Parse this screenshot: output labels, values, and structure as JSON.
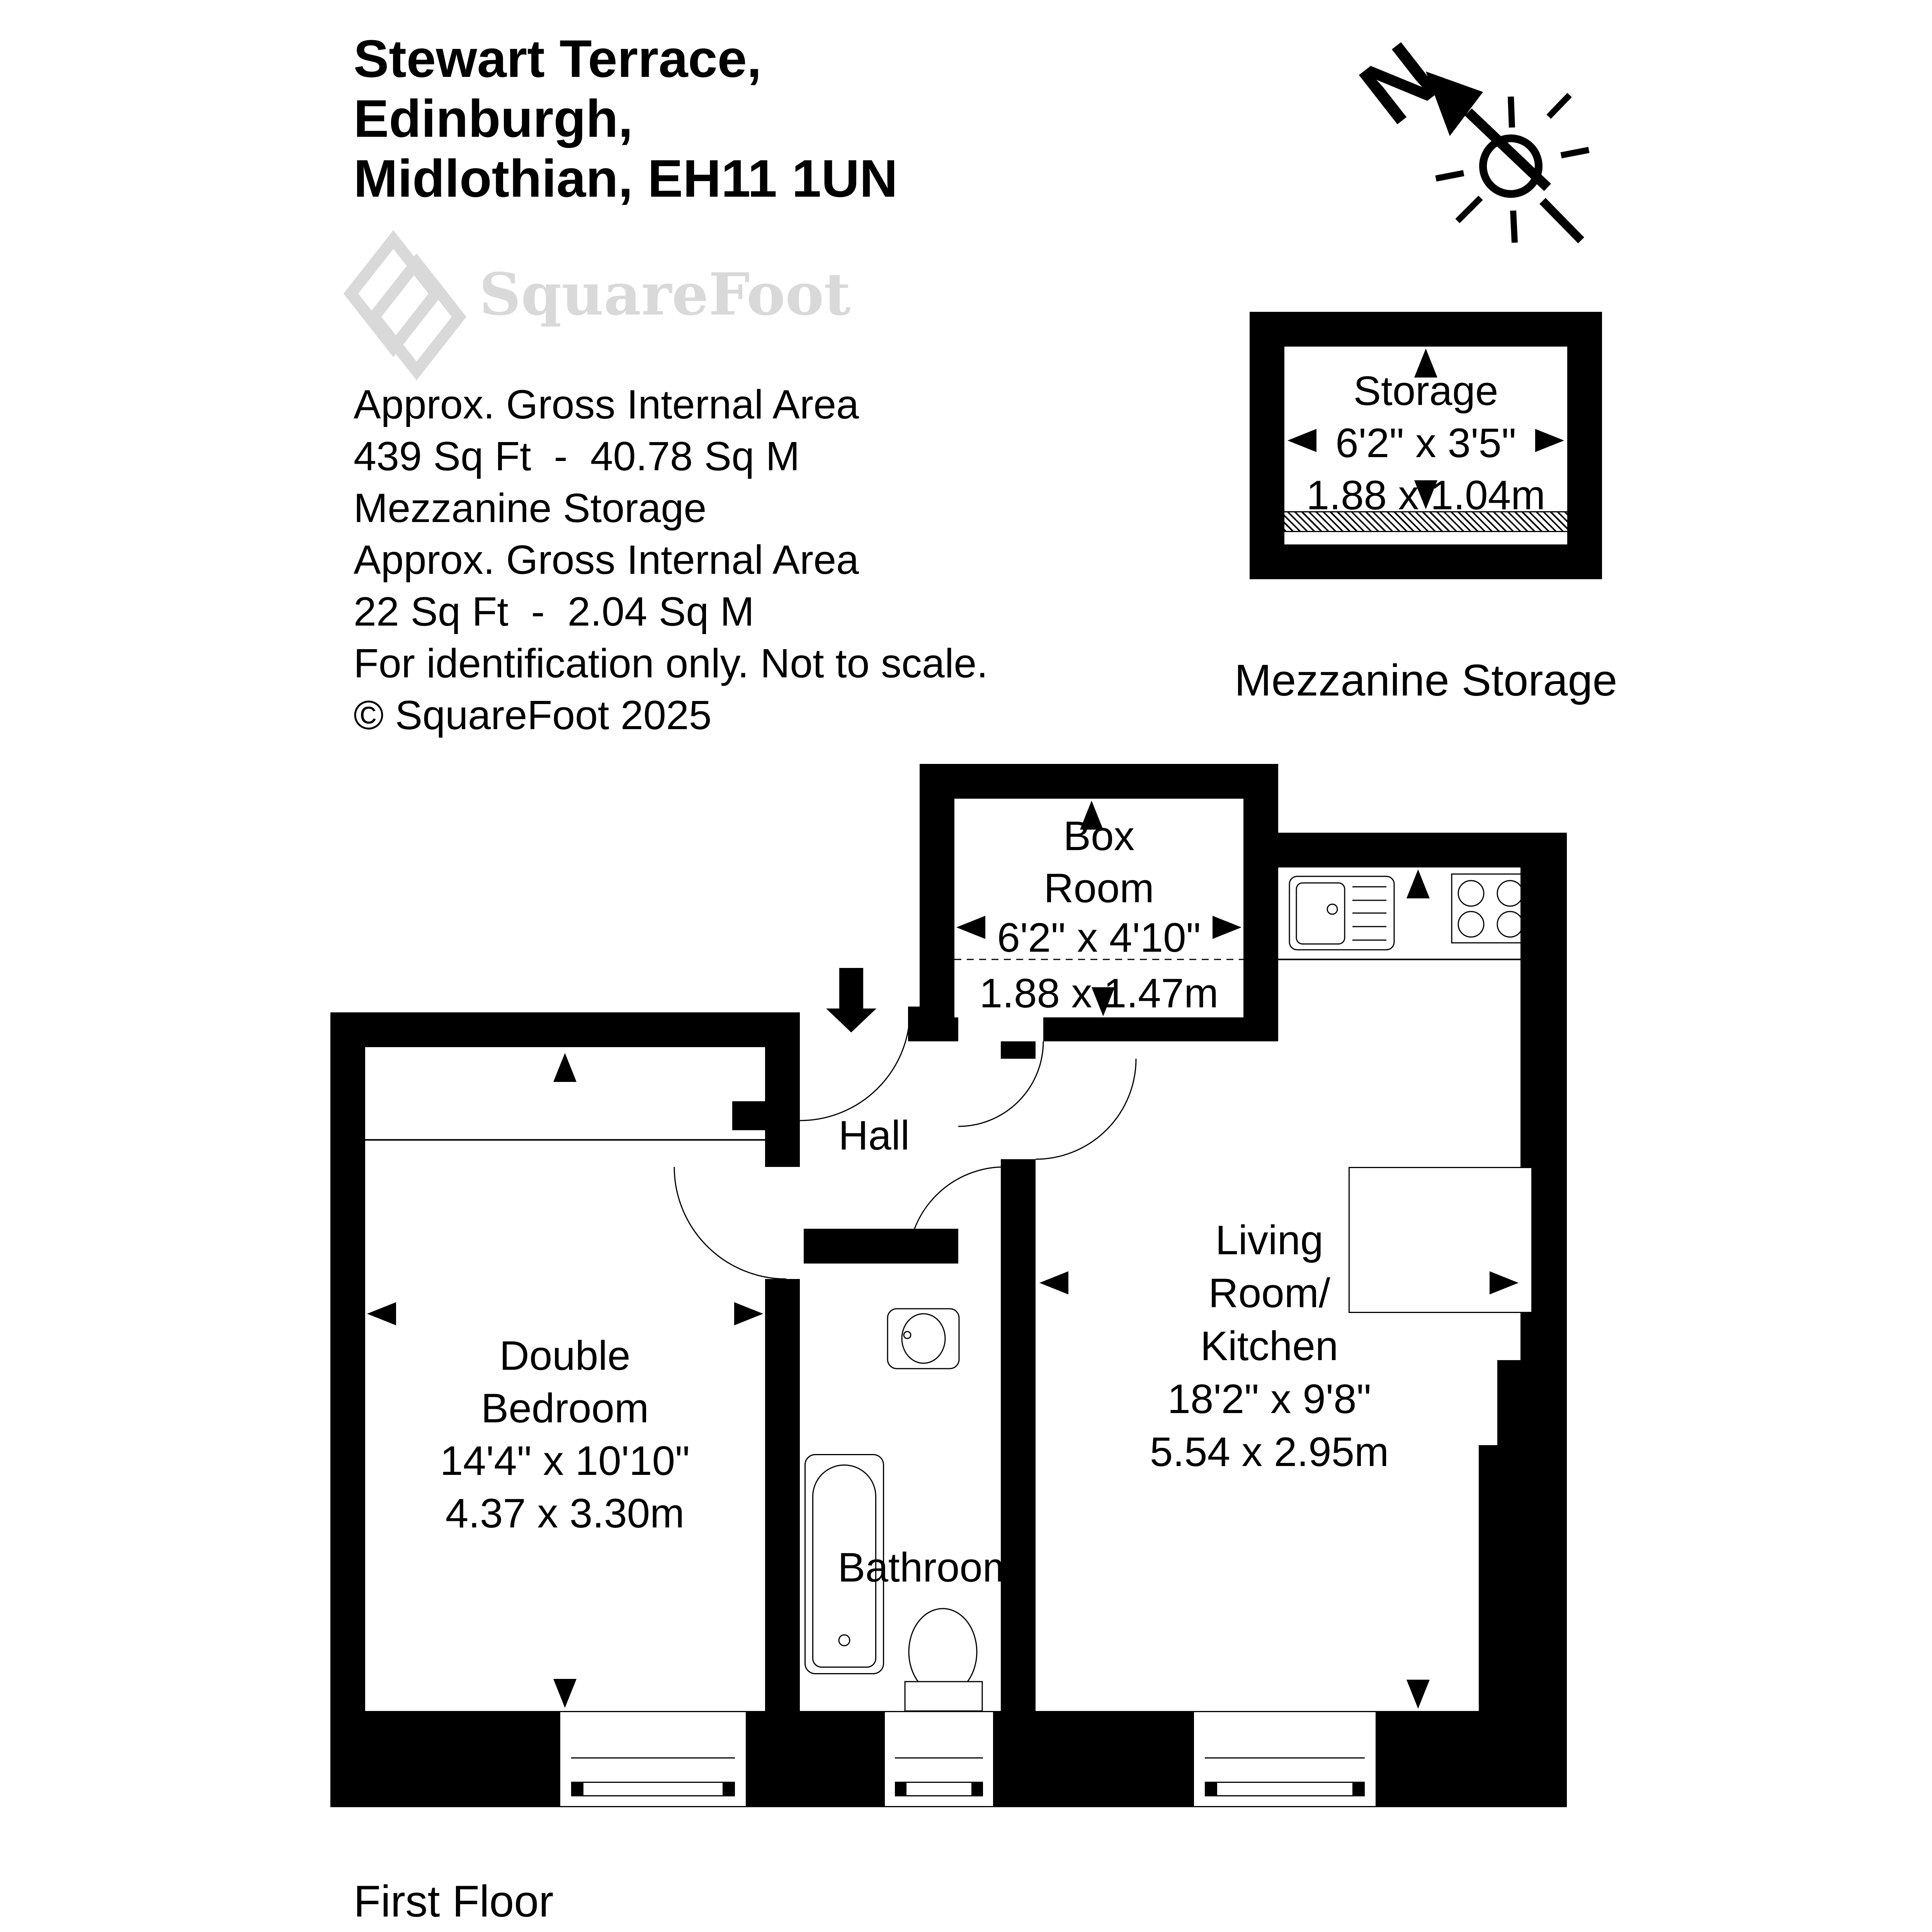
{
  "header": {
    "address_line1": "Stewart Terrace,",
    "address_line2": "Edinburgh,",
    "address_line3": "Midlothian, EH11 1UN"
  },
  "logo": {
    "brand": "SquareFoot"
  },
  "area_summary": {
    "line1": "Approx. Gross Internal Area",
    "line2": "439 Sq Ft  -  40.78 Sq M",
    "line3": "Mezzanine Storage",
    "line4": "Approx. Gross Internal Area",
    "line5": "22 Sq Ft  -  2.04 Sq M",
    "line6": "For identification only. Not to scale.",
    "line7": "© SquareFoot 2025"
  },
  "compass": {
    "north_label": "N"
  },
  "mezzanine_plan": {
    "room_label": "Storage",
    "dims_imperial": "6'2\" x 3'5\"",
    "dims_metric": "1.88 x 1.04m",
    "caption": "Mezzanine Storage"
  },
  "rooms": {
    "box_room": {
      "name_line1": "Box",
      "name_line2": "Room",
      "dims_imperial": "6'2\" x 4'10\"",
      "dims_metric": "1.88 x 1.47m"
    },
    "hall": {
      "name": "Hall"
    },
    "double_bedroom": {
      "name_line1": "Double",
      "name_line2": "Bedroom",
      "dims_imperial": "14'4\" x 10'10\"",
      "dims_metric": "4.37 x 3.30m"
    },
    "bathroom": {
      "name": "Bathroom"
    },
    "living_room_kitchen": {
      "name_line1": "Living",
      "name_line2": "Room/",
      "name_line3": "Kitchen",
      "dims_imperial": "18'2\" x 9'8\"",
      "dims_metric": "5.54 x 2.95m"
    }
  },
  "floor_label": "First Floor",
  "colors": {
    "wall": "#000000",
    "background": "#ffffff",
    "logo_gray": "#d9d9d9"
  }
}
